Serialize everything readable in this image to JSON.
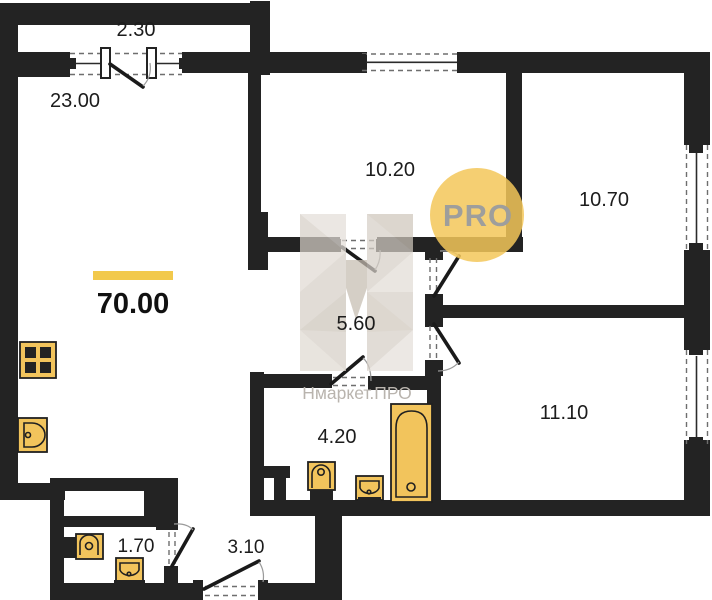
{
  "floorplan": {
    "total_area_label": "70.00",
    "watermark_logo": "PRO",
    "watermark_brand": "Нмаркет.ПРО",
    "rooms": {
      "balcony": "2.30",
      "living_kitchen": "23.00",
      "room_top_middle": "10.20",
      "room_top_right": "10.70",
      "corridor": "5.60",
      "bathroom": "4.20",
      "room_bottom_right": "11.10",
      "wc": "1.70",
      "hallway": "3.10"
    },
    "colors": {
      "walls": "#232323",
      "fixtures": "#f2c45c",
      "area_accent_bar": "#f2c94c",
      "watermark_circle": "#f3c759",
      "watermark_text": "#9e9e9c",
      "brand_text": "#b9b4ae"
    }
  }
}
